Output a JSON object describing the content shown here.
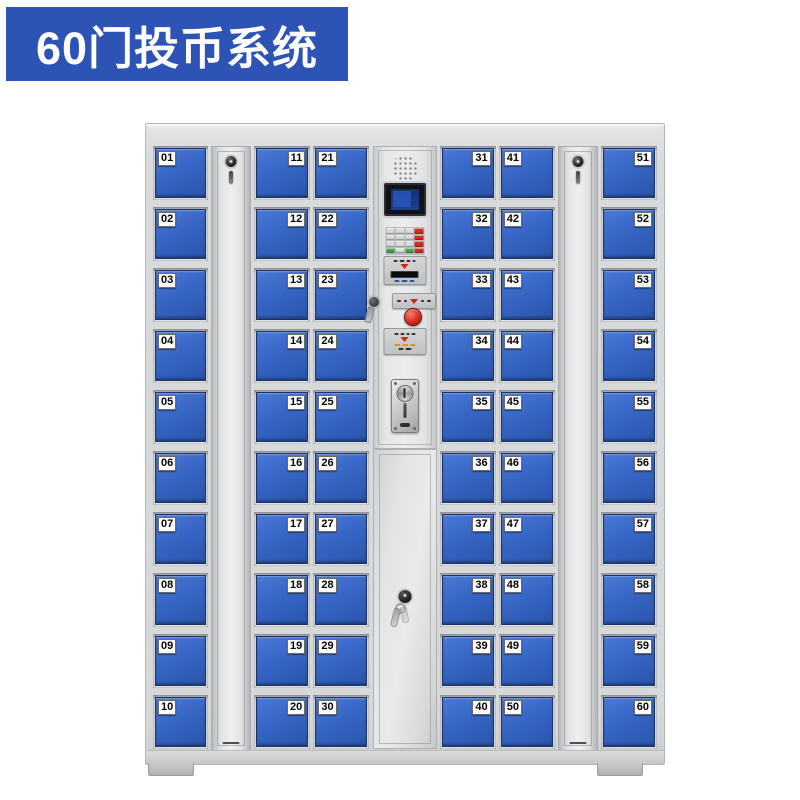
{
  "banner": {
    "title": "60门投币系统",
    "background": "#2d53b4",
    "text_color": "#ffffff"
  },
  "cabinet": {
    "door_count": 60,
    "frame_color": "#d6d8da",
    "door_blue": "#3261bf",
    "columns": [
      {
        "label_side": "left",
        "doors": [
          "01",
          "02",
          "03",
          "04",
          "05",
          "06",
          "07",
          "08",
          "09",
          "10"
        ]
      },
      {
        "label_side": "right",
        "doors": [
          "11",
          "12",
          "13",
          "14",
          "15",
          "16",
          "17",
          "18",
          "19",
          "20"
        ]
      },
      {
        "label_side": "left",
        "doors": [
          "21",
          "22",
          "23",
          "24",
          "25",
          "26",
          "27",
          "28",
          "29",
          "30"
        ]
      },
      {
        "label_side": "right",
        "doors": [
          "31",
          "32",
          "33",
          "34",
          "35",
          "36",
          "37",
          "38",
          "39",
          "40"
        ]
      },
      {
        "label_side": "left",
        "doors": [
          "41",
          "42",
          "43",
          "44",
          "45",
          "46",
          "47",
          "48",
          "49",
          "50"
        ]
      },
      {
        "label_side": "right",
        "doors": [
          "51",
          "52",
          "53",
          "54",
          "55",
          "56",
          "57",
          "58",
          "59",
          "60"
        ]
      }
    ],
    "side_lock_strips": 2
  },
  "control_panel": {
    "components": [
      "speaker-grille",
      "lcd-display",
      "numeric-keypad",
      "card-reader",
      "key-lock",
      "red-start-button",
      "instruction-plate",
      "coin-acceptor",
      "service-door-lock"
    ],
    "colors": {
      "button_red": "#d0281c",
      "keypad_red": "#cf3024",
      "keypad_green": "#45a64d",
      "screen_blue": "#1d3f92"
    },
    "keypad_grid": {
      "rows": 4,
      "cols": 4
    }
  }
}
